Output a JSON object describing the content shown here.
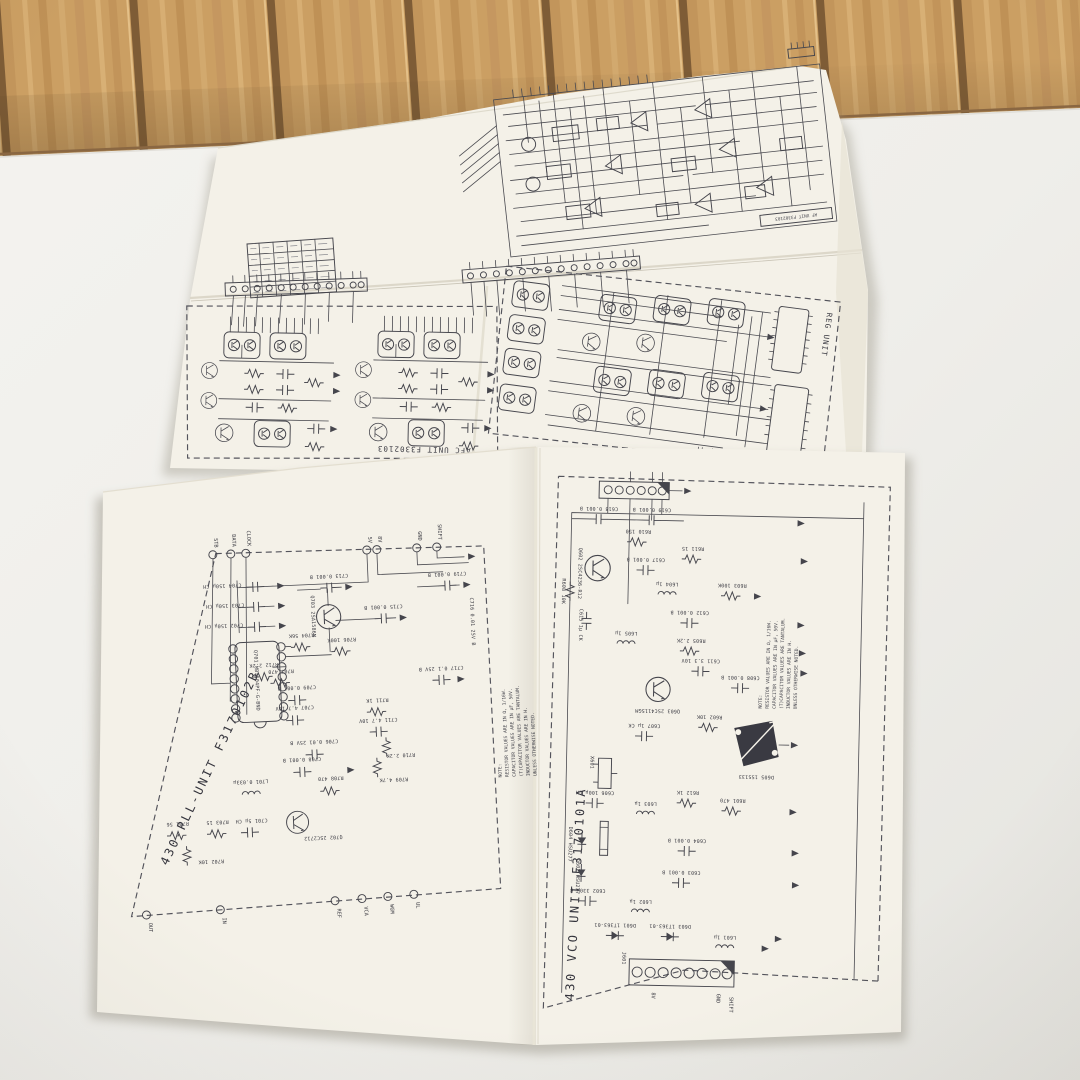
{
  "scene": {
    "description": "Folded vintage radio service-manual schematic sheets lying on a white table in front of a wood-panel wall"
  },
  "colors": {
    "wood": "#c99e63",
    "wood_groove": "#7e5c36",
    "table": "#f2f1ec",
    "paper": "#f4f1e8",
    "ink": "#4a4a50"
  },
  "sheet_top": {
    "upper_schematic": {
      "title_block": "AF UNIT F3302103"
    },
    "afc_schematic": {
      "title": "AFC UNIT  F3302103"
    },
    "reg_schematic": {
      "title": "REG UNIT"
    }
  },
  "sheet_bottom": {
    "pll_schematic": {
      "title": "430-PLL-UNIT  F3170102B",
      "ic_label": "Q701 MB1504PF-G-BND",
      "top_terminals": [
        "STB",
        "DATA",
        "CLOCK",
        "5V",
        "8V",
        "GND",
        "SHIFT"
      ],
      "bottom_terminals": [
        "OUT",
        "IN",
        "REF",
        "VCA",
        "WGM",
        "UL"
      ],
      "note": [
        "NOTE:",
        "RESISTOR VALUES ARE IN Ω, 1/16W.",
        "CAPACITOR VALUES ARE IN μF, 50V.",
        "(T)CAPACITOR VALUES ARE TANTALUM.",
        "INDUCTOR VALUES ARE IN H.",
        "UNLESS OTHERWISE NOTED."
      ],
      "components": [
        "C702 150μ CH",
        "C703 150μ CH",
        "C704 150μ CH",
        "C713 0.001 B",
        "C715 0.001 B",
        "C719 0.001 B",
        "Q703 2SA1586M",
        "R704 56K",
        "R706 100K",
        "R712 2.2K",
        "R707 470",
        "C709 0.001 B",
        "C707 4.7 10V",
        "C706 0.01 25V B",
        "C708 0.001 B",
        "R708 470",
        "L701 0.033μ",
        "Q702 2SC2712",
        "C717 0.1 25V B",
        "C716 0.01 25V B",
        "R711 1K",
        "C711 4.7 10V",
        "R710 2.2K",
        "R709 4.7K",
        "R701 56",
        "R703 15",
        "C701 5μ CH",
        "R702 10K"
      ]
    },
    "vco_schematic": {
      "title": "430 VCO UNIT  F3170101A",
      "connector_label": "J601",
      "bottom_terminals": [
        "8V",
        "GND",
        "SHIFT"
      ],
      "note": [
        "NOTE:",
        "RESISTOR VALUES ARE IN Ω, 1/16W.",
        "CAPACITOR VALUES ARE IN μF, 50V.",
        "(T)CAPACITOR VALUES ARE TANTALUM.",
        "INDUCTOR VALUES ARE IN H.",
        "UNLESS OTHERWISE NOTED."
      ],
      "components": [
        "Q602 2SC4236-R12",
        "R608 10K",
        "C618 0.001 B",
        "C619 0.001 B",
        "R610 150",
        "R611 15",
        "C617 0.001 B",
        "C615 1μ CK",
        "L605 1μ",
        "R605 2.2K",
        "C612 0.001 B",
        "C611 3.3 10V",
        "Q603 2SC4115GM",
        "R602 10K",
        "C607 1μ CK",
        "D605 1SS133",
        "X601",
        "C606 100μ CH",
        "D604 HSU277",
        "D602 HSU277",
        "C602 330μ B",
        "L603 1μ",
        "R612 1K",
        "R601 470",
        "C604 0.001 B",
        "C603 0.001 B",
        "L602 1μ",
        "D601 1T363-01",
        "D603 1T363-01",
        "L601 1μ",
        "C608 0.001 B",
        "R603 100K",
        "L604 1μ",
        "J601"
      ]
    }
  }
}
